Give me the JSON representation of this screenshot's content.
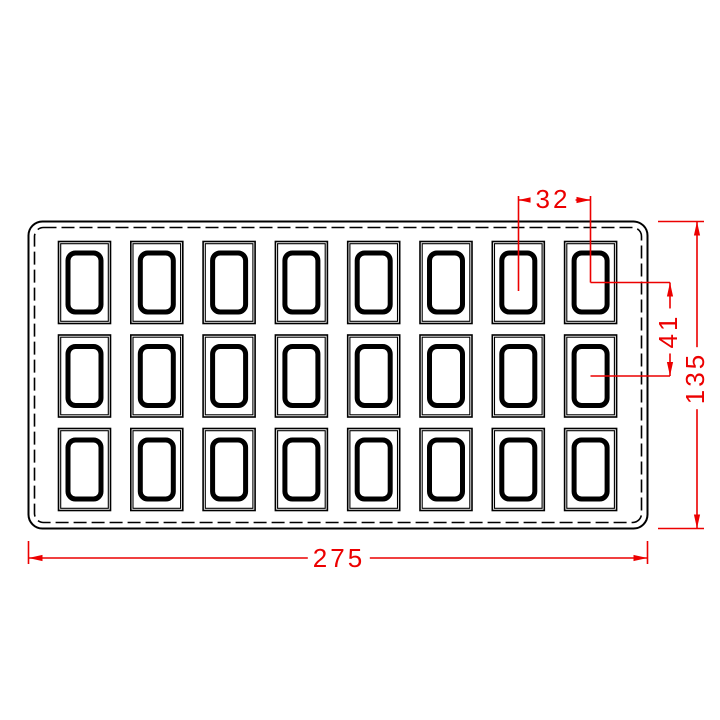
{
  "drawing": {
    "kind": "mold-tray-technical-drawing",
    "tray": {
      "rows": 3,
      "columns": 8,
      "cavity_count": 24
    },
    "dimensions": {
      "cavity_pitch_x": {
        "value": "32"
      },
      "cavity_pitch_y": {
        "value": "41"
      },
      "overall_width": {
        "value": "275"
      },
      "overall_height": {
        "value": "135"
      }
    },
    "colors": {
      "line": "#000000",
      "dimension": "#ec0000",
      "background": "#ffffff"
    }
  }
}
